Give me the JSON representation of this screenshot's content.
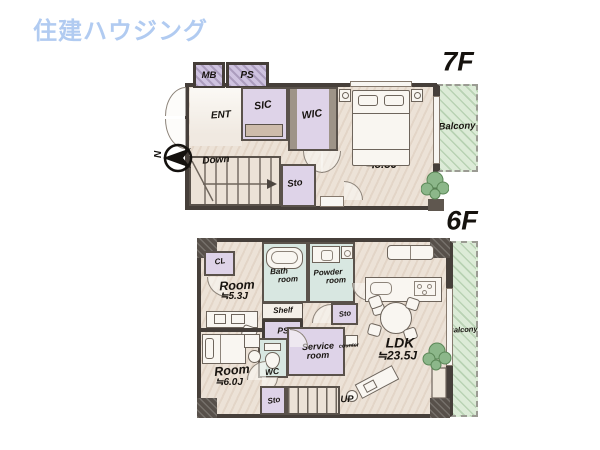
{
  "logo": {
    "text": "住建ハウジング"
  },
  "f7": {
    "label": "7F",
    "compass_n": "N",
    "rooms": {
      "mb": "MB",
      "ps": "PS",
      "ent": "ENT",
      "sic": "SIC",
      "wic": "WIC",
      "room": "Room",
      "room_size": "≒8.3J",
      "down": "Down",
      "sto": "Sto",
      "balcony": "Balcony"
    }
  },
  "f6": {
    "label": "6F",
    "rooms": {
      "cl": "CL",
      "room1": "Room",
      "room1_size": "≒5.3J",
      "bath_line1": "Bath",
      "bath_line2": "room",
      "powder_line1": "Powder",
      "powder_line2": "room",
      "shelf": "Shelf",
      "ps": "PS",
      "sto_mid": "Sto",
      "service_line1": "Service",
      "service_line2": "room",
      "wc": "WC",
      "counter": "counter",
      "ldk": "LDK",
      "ldk_size": "≒23.5J",
      "room2": "Room",
      "room2_size": "≒6.0J",
      "sto_bottom": "Sto",
      "up": "UP",
      "balcony": "Balcony"
    }
  },
  "colors": {
    "logo_blue": "#b1cbf1",
    "floor_beige": "#ece2d7",
    "room_purple": "#ded3e8",
    "bath_teal": "#d8e7e1",
    "balcony_green": "#dcebd7",
    "wall_dark": "#463f3a"
  }
}
